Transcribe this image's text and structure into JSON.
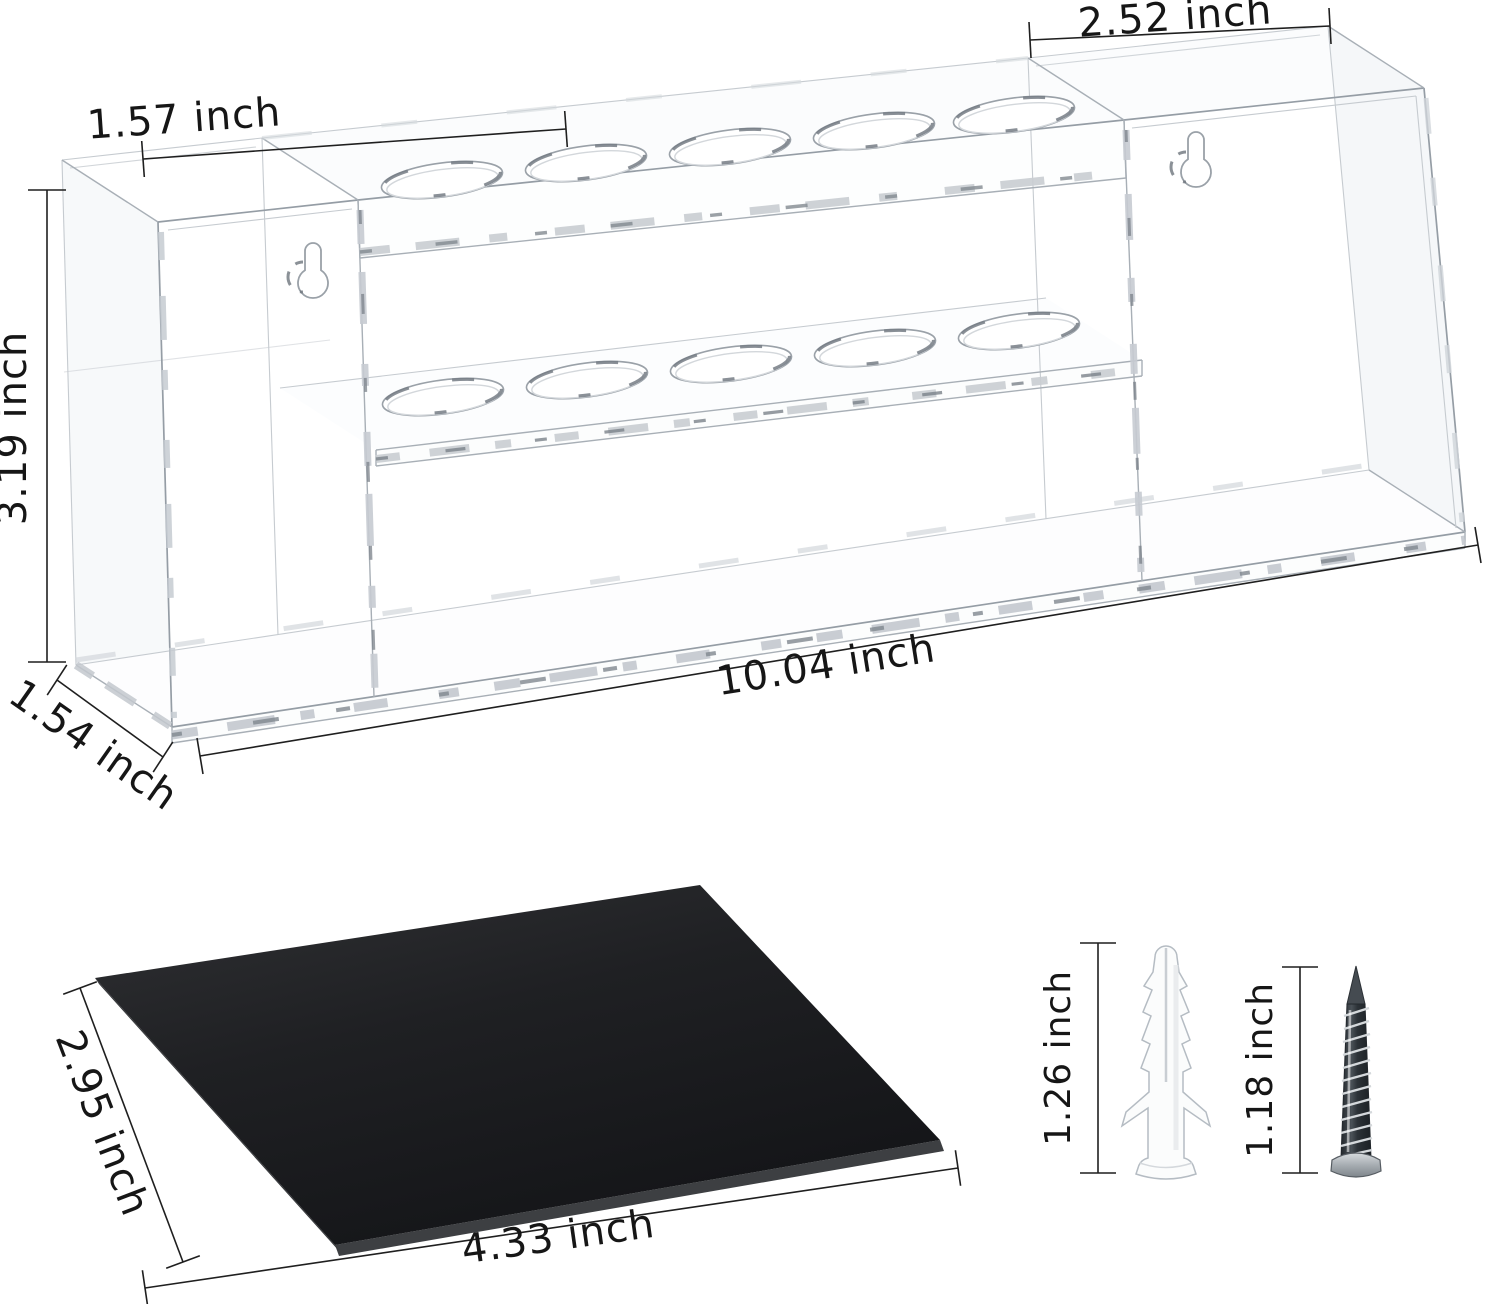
{
  "labels": {
    "left_section_width": "1.57 inch",
    "right_section_width": "2.52 inch",
    "height": "3.19 inch",
    "depth": "1.54 inch",
    "total_width": "10.04 inch",
    "mat_depth": "2.95 inch",
    "mat_width": "4.33 inch",
    "anchor_length": "1.26 inch",
    "screw_length": "1.18 inch"
  },
  "parts": {
    "rack": {
      "material_look": "clear acrylic wireframe",
      "top_row_holes": 5,
      "shelf_row_holes": 5,
      "keyhole_slots": 2
    },
    "mat": {
      "color": "#1d1e21"
    },
    "hardware": {
      "anchor": "wall-anchor",
      "screw": "mounting-screw"
    }
  },
  "unit": "inch"
}
